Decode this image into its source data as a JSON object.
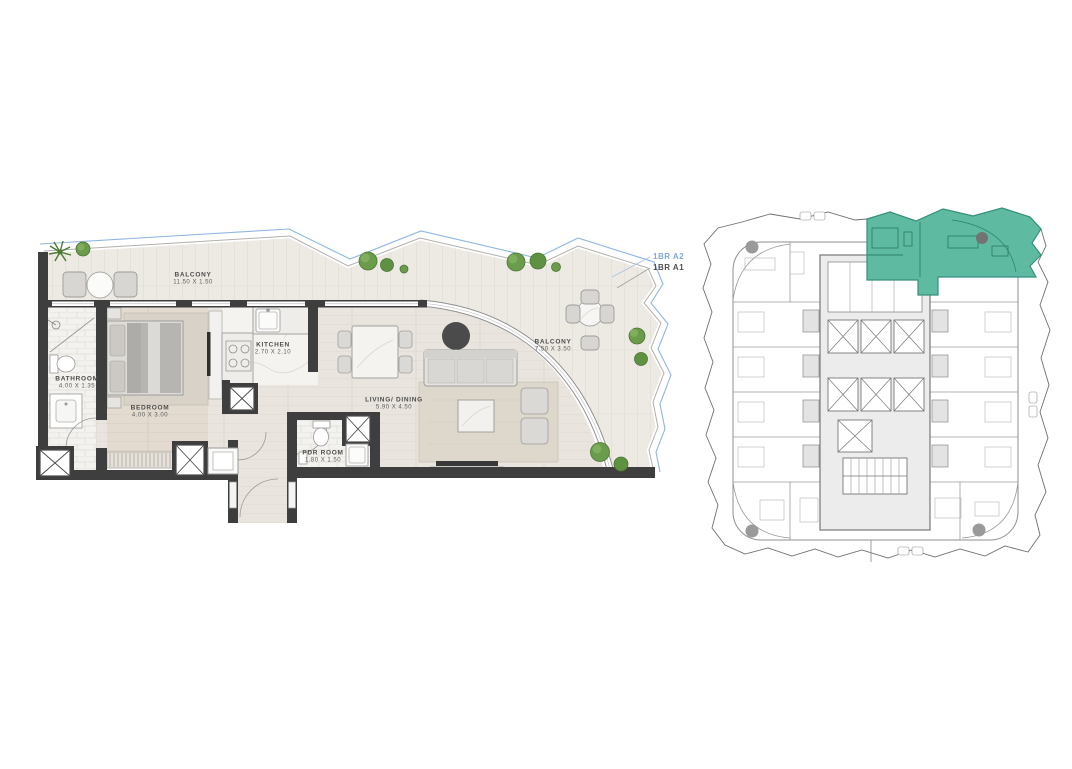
{
  "unit_plan": {
    "rooms": [
      {
        "name": "BALCONY",
        "dims": "11.50 X 1.50"
      },
      {
        "name": "BATHROOM",
        "dims": "4.00 X 1.35"
      },
      {
        "name": "BEDROOM",
        "dims": "4.00 X 3.00"
      },
      {
        "name": "KITCHEN",
        "dims": "2.70 X 2.10"
      },
      {
        "name": "LIVING/ DINING",
        "dims": "5.90 X 4.50"
      },
      {
        "name": "PDR ROOM",
        "dims": "1.80 X 1.50"
      },
      {
        "name": "BALCONY",
        "dims": "7.50 X 3.50"
      }
    ],
    "callouts": [
      {
        "label": "1BR A2",
        "color": "#7fa8d9"
      },
      {
        "label": "1BR A1",
        "color": "#4f4f4f"
      }
    ]
  },
  "key_plan": {
    "highlight_color": "#5ebba2"
  },
  "colors": {
    "walls": "#3e3e3e",
    "balustrade_line": "#8fb6e2",
    "keyplan_highlight": "#5ebba2",
    "keyplan_linework": "#8f8f8f"
  }
}
